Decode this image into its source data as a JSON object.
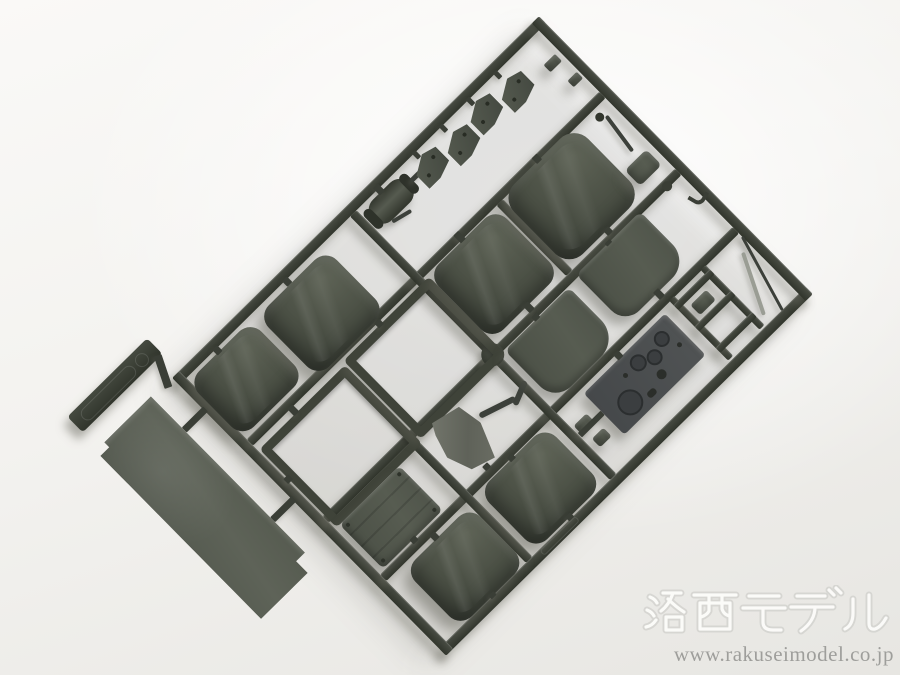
{
  "scene": {
    "type": "photograph",
    "subject": "Plastic model kit sprue (parts runner) molded in olive-drab styrene, lying diagonally on a white studio background",
    "background_color": "#f3f2ef",
    "plastic_color": "#474c41",
    "runner_color": "#3b3f37",
    "shadow_direction": "lower-left"
  },
  "watermark": {
    "logo_text": "洛西モデル",
    "url": "www.rakuseimodel.co.jp",
    "logo_outline_color": "#d6d6d2",
    "url_color": "#9b9b98"
  },
  "sprue": {
    "orientation_deg": -44.6,
    "frame": "rectangular outer runner with internal cross rails and a thick center node",
    "parts": [
      {
        "name": "sprue-tag",
        "desc": "molded tag bar with embossed oval marking, outside lower-left corner"
      },
      {
        "name": "floor-panel",
        "desc": "long flat olive panel with stepped corner notches, outside left rail"
      },
      {
        "name": "seat-cushion-1",
        "desc": "small rounded seat cushion, top row left"
      },
      {
        "name": "seat-cushion-2",
        "desc": "rounded seat cushion, top row"
      },
      {
        "name": "seat-cushion-3",
        "desc": "large rounded seat cushion, middle row"
      },
      {
        "name": "seat-cushion-4",
        "desc": "largest rounded seat cushion, middle row right"
      },
      {
        "name": "seat-cushion-5",
        "desc": "rounded seat cushion, bottom row left"
      },
      {
        "name": "seat-cushion-6",
        "desc": "rounded seat cushion, bottom row"
      },
      {
        "name": "seat-frame-1",
        "desc": "open square seat frame"
      },
      {
        "name": "seat-frame-2",
        "desc": "open square seat frame"
      },
      {
        "name": "backrest-panel-1",
        "desc": "flat backrest panel with rounded lower edge"
      },
      {
        "name": "backrest-panel-2",
        "desc": "flat backrest panel with rounded lower edge"
      },
      {
        "name": "instrument-panel",
        "desc": "dashboard plate with molded gauges and holes"
      },
      {
        "name": "mounting-bracket-1",
        "desc": "angular bracket with two holes"
      },
      {
        "name": "mounting-bracket-2",
        "desc": "angular bracket with two holes"
      },
      {
        "name": "mounting-bracket-3",
        "desc": "angular bracket with two holes"
      },
      {
        "name": "mounting-bracket-4",
        "desc": "angular bracket with two holes"
      },
      {
        "name": "winch-drum",
        "desc": "small cylindrical drum with end flanges"
      },
      {
        "name": "storage-box-lid",
        "desc": "ribbed rectangular lid with rivets"
      },
      {
        "name": "canvas-tarp",
        "desc": "small wrinkled tarpaulin piece, lighter gray"
      },
      {
        "name": "exhaust-pipe",
        "desc": "bent rod part"
      },
      {
        "name": "gear-lever",
        "desc": "thin lever with knob, right column"
      },
      {
        "name": "rear-view-mirror",
        "desc": "small flat mirror plate"
      },
      {
        "name": "control-knob",
        "desc": "tiny round knob"
      },
      {
        "name": "towing-hook",
        "desc": "small bent hook"
      },
      {
        "name": "wiper-rod-1",
        "desc": "long thin rod near right corner"
      },
      {
        "name": "wiper-rod-2",
        "desc": "long thin light-gray rod near right corner"
      },
      {
        "name": "step-ladder-runner",
        "desc": "ladder-like runner section with rungs and step plate"
      },
      {
        "name": "small-clip-1",
        "desc": "tiny clip part on center rail"
      },
      {
        "name": "small-clip-2",
        "desc": "tiny clip part on center rail"
      }
    ]
  }
}
